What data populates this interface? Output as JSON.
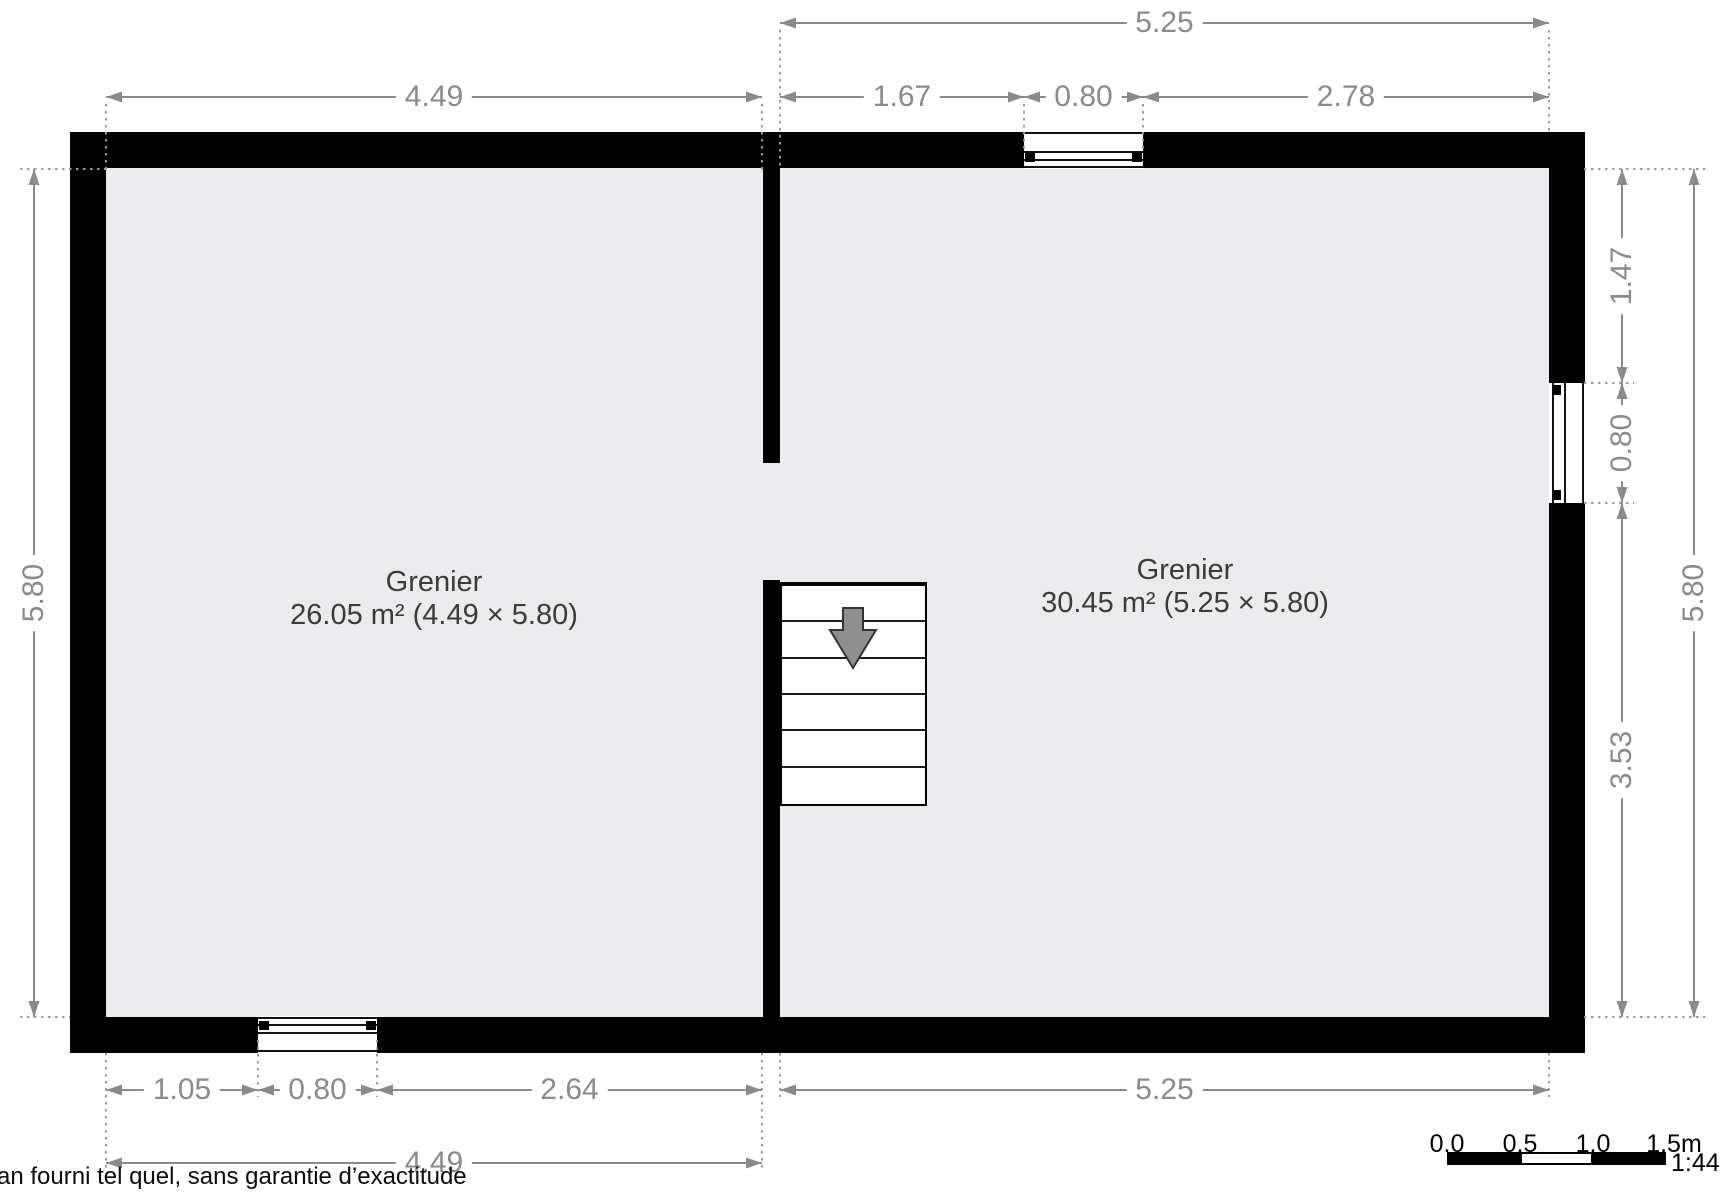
{
  "plan": {
    "rooms": [
      {
        "name": "Grenier",
        "area_line": "26.05 m² (4.49 × 5.80)"
      },
      {
        "name": "Grenier",
        "area_line": "30.45 m² (5.25 × 5.80)"
      }
    ],
    "dimensions_horizontal": [
      {
        "label": "5.25",
        "x1": 780,
        "x2": 1549,
        "y": 23
      },
      {
        "label": "4.49",
        "x1": 106,
        "x2": 762,
        "y": 97
      },
      {
        "label": "1.67",
        "x1": 780,
        "x2": 1024,
        "y": 97
      },
      {
        "label": "0.80",
        "x1": 1024,
        "x2": 1143,
        "y": 97
      },
      {
        "label": "2.78",
        "x1": 1143,
        "x2": 1549,
        "y": 97
      },
      {
        "label": "1.05",
        "x1": 106,
        "x2": 258,
        "y": 1090
      },
      {
        "label": "0.80",
        "x1": 258,
        "x2": 377,
        "y": 1090
      },
      {
        "label": "2.64",
        "x1": 377,
        "x2": 762,
        "y": 1090
      },
      {
        "label": "5.25",
        "x1": 780,
        "x2": 1549,
        "y": 1090
      },
      {
        "label": "4.49",
        "x1": 106,
        "x2": 762,
        "y": 1163
      }
    ],
    "dimensions_vertical": [
      {
        "label": "5.80",
        "x": 34,
        "y1": 169,
        "y2": 1017
      },
      {
        "label": "1.47",
        "x": 1622,
        "y1": 169,
        "y2": 383
      },
      {
        "label": "0.80",
        "x": 1622,
        "y1": 383,
        "y2": 503
      },
      {
        "label": "3.53",
        "x": 1622,
        "y1": 503,
        "y2": 1017
      },
      {
        "label": "5.80",
        "x": 1694,
        "y1": 169,
        "y2": 1017
      }
    ]
  },
  "footer": {
    "disclaimer": "an fourni tel quel, sans garantie d’exactitude"
  },
  "scale_bar": {
    "tick_labels": [
      "0.0",
      "0.5",
      "1.0",
      "1.5m"
    ],
    "ratio": "1:44"
  },
  "colors": {
    "wall": "#000000",
    "floor": "#ececee",
    "dimension": "#8a8a8a",
    "room_label": "#3b3b3b"
  }
}
